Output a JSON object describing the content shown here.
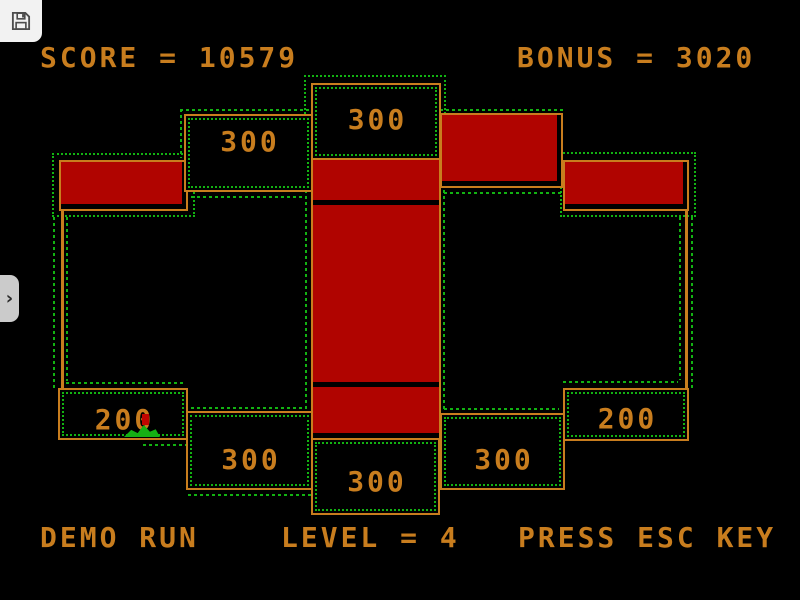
{
  "emulator_ui": {
    "save_button": {
      "icon": "floppy-disk-icon"
    },
    "sidebar_toggle": {
      "chevron": "›"
    }
  },
  "hud": {
    "score_text": "SCORE = 10579",
    "bonus_text": "BONUS = 3020"
  },
  "status_bar": {
    "demo_text": "DEMO RUN",
    "level_text": "LEVEL = 4",
    "esc_text": "PRESS ESC KEY"
  },
  "board": {
    "value_boxes": [
      {
        "id": "top-center-300",
        "value": "300"
      },
      {
        "id": "upper-left-300",
        "value": "300"
      },
      {
        "id": "bottom-left-200",
        "value": "200"
      },
      {
        "id": "bottom-left-300",
        "value": "300"
      },
      {
        "id": "bottom-center-300",
        "value": "300"
      },
      {
        "id": "bottom-right-300",
        "value": "300"
      },
      {
        "id": "bottom-right-200",
        "value": "200"
      }
    ],
    "filled_blocks": [
      "left",
      "top-right-center",
      "right",
      "center-column-top",
      "center-column-middle",
      "center-column-bottom"
    ],
    "player": {
      "sprite": "green-creature",
      "body_color": "#14b014",
      "marker_color": "#c00500"
    },
    "colors": {
      "wall_orange": "#c87d1e",
      "block_red": "#b00400",
      "trail_green": "#12b212",
      "text_orange": "#c87d1e"
    }
  }
}
